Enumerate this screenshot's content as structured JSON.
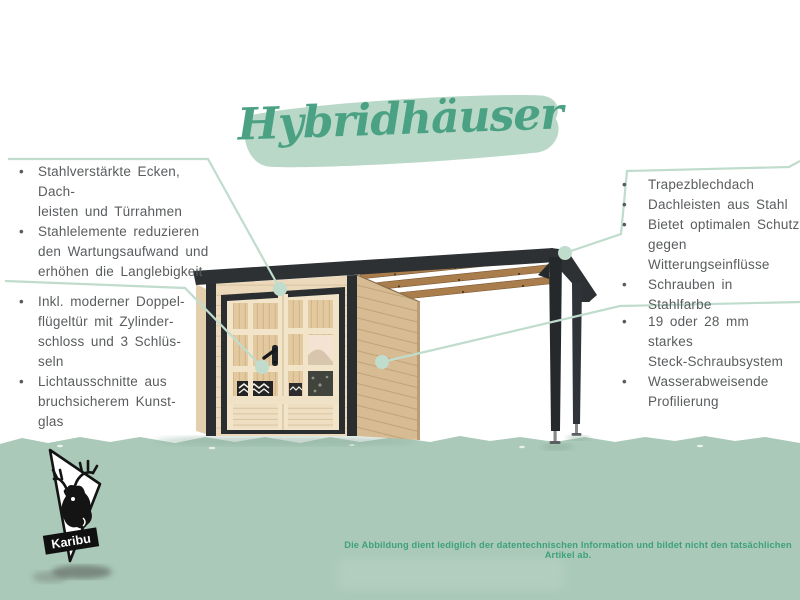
{
  "title": {
    "text": "Hybridhäuser"
  },
  "glyphs": {
    "bullet": "•"
  },
  "callouts": {
    "left_top": {
      "items": [
        {
          "text": "Stahlverstärkte Ecken, Dach-\nleisten und Türrahmen"
        },
        {
          "text": "Stahlelemente reduzieren\nden Wartungsaufwand und\nerhöhen die Langlebigkeit"
        }
      ]
    },
    "left_bottom": {
      "items": [
        {
          "text": "Inkl. moderner Doppel-\nflügeltür mit Zylinder-\nschloss und 3 Schlüs-\nseln"
        },
        {
          "text": "Lichtausschnitte aus\nbruchsicherem Kunst-\nglas"
        }
      ]
    },
    "right_top": {
      "items": [
        {
          "text": "Trapezblechdach"
        },
        {
          "text": "Dachleisten aus Stahl"
        },
        {
          "text": "Bietet optimalen Schutz\ngegen Witterungseinflüsse"
        },
        {
          "text": "Schrauben in Stahlfarbe"
        }
      ]
    },
    "right_bottom": {
      "items": [
        {
          "text": "19 oder 28 mm starkes\nSteck-Schraubsystem"
        },
        {
          "text": "Wasserabweisende\nProfilierung"
        }
      ]
    }
  },
  "footer": {
    "disclaimer": "Die Abbildung dient lediglich der datentechnischen Information und bildet nicht den tatsächlichen Artikel ab."
  },
  "brand": {
    "name": "Karibu"
  },
  "colors": {
    "accent_green": "#4ba183",
    "brush_sage": "#b9d8c8",
    "leader_sage": "#bfdccd",
    "ground_green": "#aac9b8",
    "text_gray": "#595c5e",
    "anthracite": "#2e3134",
    "wood_front": "#ecd9bc",
    "wood_side": "#d7bb93",
    "beam_brown": "#aa7d4d"
  }
}
